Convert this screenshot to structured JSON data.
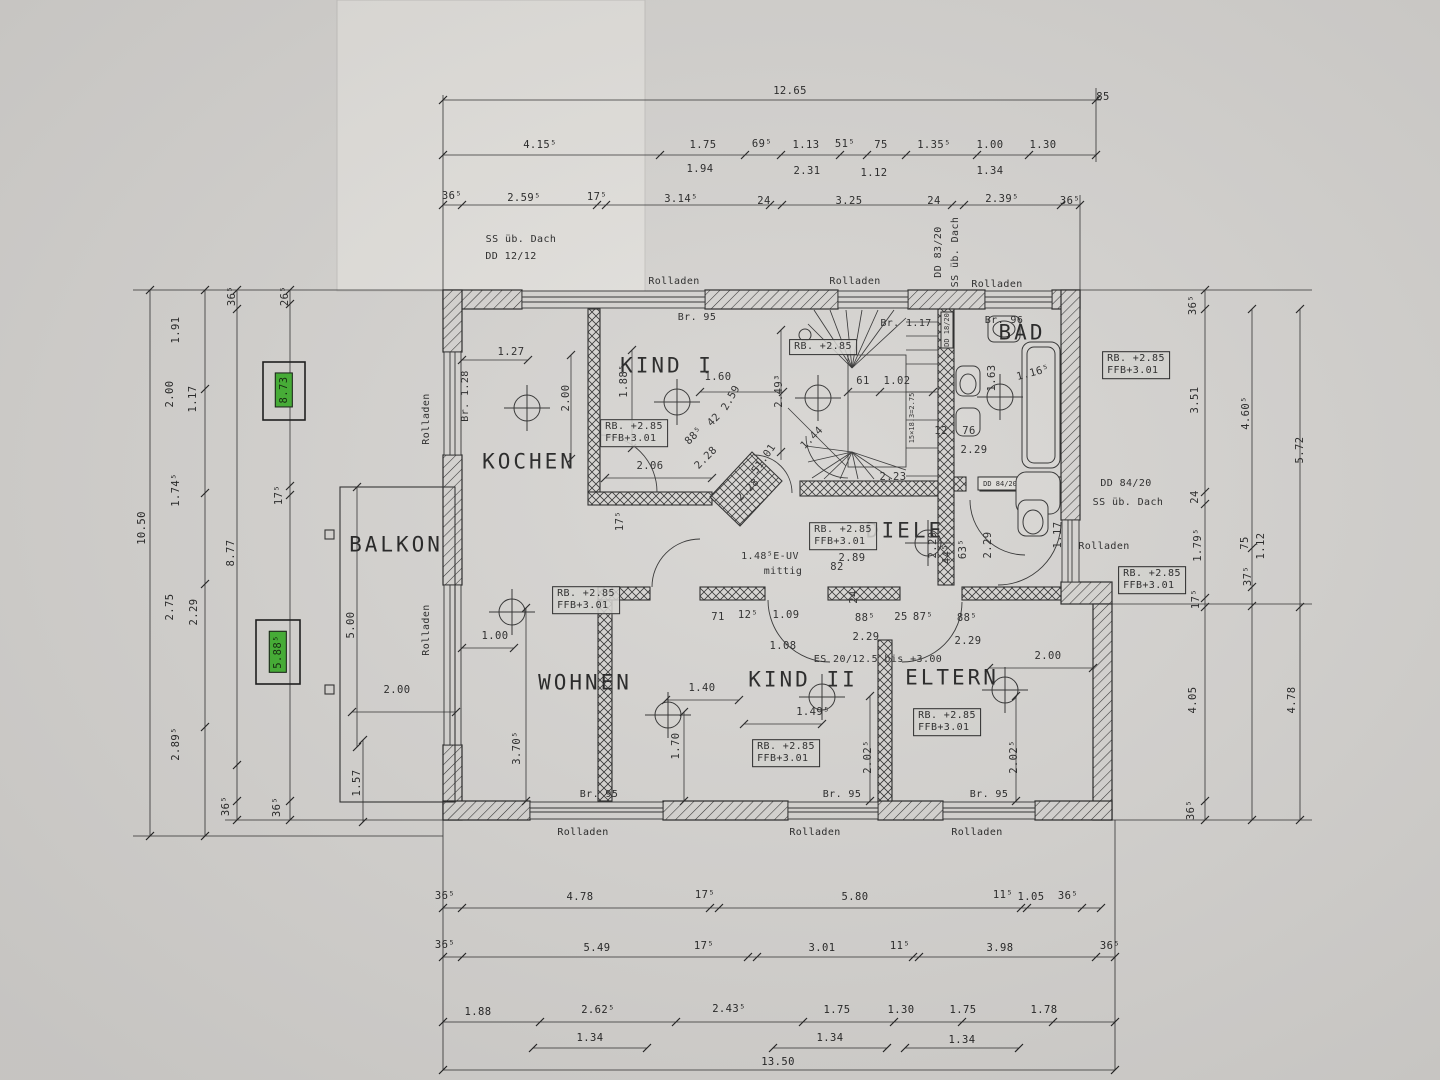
{
  "colors": {
    "paper": "#d5d3d0",
    "ink": "#262626",
    "highlight_green": "#3fae2e",
    "sheet_light": "#e2e0dc"
  },
  "drawing": {
    "type": "floor-plan",
    "language": "de"
  },
  "labels": [
    {
      "t": "12.65",
      "x": 790,
      "y": 91
    },
    {
      "t": "85",
      "x": 1103,
      "y": 97
    },
    {
      "t": "4.15⁵",
      "x": 540,
      "y": 145
    },
    {
      "t": "1.75",
      "x": 703,
      "y": 145
    },
    {
      "t": "69⁵",
      "x": 762,
      "y": 144
    },
    {
      "t": "1.13",
      "x": 806,
      "y": 145
    },
    {
      "t": "51⁵",
      "x": 845,
      "y": 144
    },
    {
      "t": "75",
      "x": 881,
      "y": 145
    },
    {
      "t": "1.35⁵",
      "x": 934,
      "y": 145
    },
    {
      "t": "1.00",
      "x": 990,
      "y": 145
    },
    {
      "t": "1.30",
      "x": 1043,
      "y": 145
    },
    {
      "t": "1.94",
      "x": 700,
      "y": 169
    },
    {
      "t": "2.31",
      "x": 807,
      "y": 171
    },
    {
      "t": "1.12",
      "x": 874,
      "y": 173
    },
    {
      "t": "1.34",
      "x": 990,
      "y": 171
    },
    {
      "t": "36⁵",
      "x": 452,
      "y": 196
    },
    {
      "t": "2.59⁵",
      "x": 524,
      "y": 198
    },
    {
      "t": "17⁵",
      "x": 597,
      "y": 197
    },
    {
      "t": "3.14⁵",
      "x": 681,
      "y": 199
    },
    {
      "t": "24",
      "x": 764,
      "y": 201
    },
    {
      "t": "3.25",
      "x": 849,
      "y": 201
    },
    {
      "t": "24",
      "x": 934,
      "y": 201
    },
    {
      "t": "2.39⁵",
      "x": 1002,
      "y": 199
    },
    {
      "t": "36⁵",
      "x": 1070,
      "y": 201
    },
    {
      "t": "SS üb. Dach",
      "x": 521,
      "y": 240,
      "k": "note"
    },
    {
      "t": "DD 12/12",
      "x": 511,
      "y": 257,
      "k": "note"
    },
    {
      "t": "Rolladen",
      "x": 674,
      "y": 282,
      "k": "note"
    },
    {
      "t": "Rolladen",
      "x": 855,
      "y": 282,
      "k": "note"
    },
    {
      "t": "Rolladen",
      "x": 997,
      "y": 285,
      "k": "note"
    },
    {
      "t": "DD 83/20",
      "x": 939,
      "y": 252,
      "r": -90,
      "k": "note"
    },
    {
      "t": "SS üb. Dach",
      "x": 956,
      "y": 252,
      "r": -90,
      "k": "note"
    },
    {
      "t": "Br. 95",
      "x": 697,
      "y": 318,
      "k": "note"
    },
    {
      "t": "Br. 1.17",
      "x": 906,
      "y": 324,
      "k": "note"
    },
    {
      "t": "Br. 96",
      "x": 1004,
      "y": 321,
      "k": "note"
    },
    {
      "t": "Br. 1.28",
      "x": 466,
      "y": 396,
      "r": -90,
      "k": "note"
    },
    {
      "t": "KOCHEN",
      "x": 529,
      "y": 462,
      "k": "room"
    },
    {
      "t": "KIND I",
      "x": 667,
      "y": 366,
      "k": "room"
    },
    {
      "t": "BAD",
      "x": 1022,
      "y": 333,
      "k": "room"
    },
    {
      "t": "BALKON",
      "x": 396,
      "y": 545,
      "k": "room"
    },
    {
      "t": "WOHNEN",
      "x": 585,
      "y": 683,
      "k": "room"
    },
    {
      "t": "KIND II",
      "x": 803,
      "y": 680,
      "k": "room"
    },
    {
      "t": "ELTERN",
      "x": 952,
      "y": 678,
      "k": "room"
    },
    {
      "t": "DIELE",
      "x": 905,
      "y": 531,
      "k": "room"
    },
    {
      "t": "RB. +2.85\nFFB+3.01",
      "x": 634,
      "y": 433,
      "k": "box"
    },
    {
      "t": "RB. +2.85",
      "x": 823,
      "y": 347,
      "k": "box"
    },
    {
      "t": "RB. +2.85\nFFB+3.01",
      "x": 586,
      "y": 600,
      "k": "box"
    },
    {
      "t": "RB. +2.85\nFFB+3.01",
      "x": 843,
      "y": 536,
      "k": "box"
    },
    {
      "t": "RB. +2.85\nFFB+3.01",
      "x": 786,
      "y": 753,
      "k": "box"
    },
    {
      "t": "RB. +2.85\nFFB+3.01",
      "x": 947,
      "y": 722,
      "k": "box"
    },
    {
      "t": "RB. +2.85\nFFB+3.01",
      "x": 1136,
      "y": 365,
      "k": "box"
    },
    {
      "t": "RB. +2.85\nFFB+3.01",
      "x": 1152,
      "y": 580,
      "k": "box"
    },
    {
      "t": "8.73",
      "x": 284,
      "y": 390,
      "r": -90,
      "k": "green"
    },
    {
      "t": "5.88⁵",
      "x": 278,
      "y": 652,
      "r": -90,
      "k": "green"
    },
    {
      "t": "1.27",
      "x": 511,
      "y": 352
    },
    {
      "t": "2.00",
      "x": 566,
      "y": 398,
      "r": -90
    },
    {
      "t": "1.88⁵",
      "x": 624,
      "y": 381,
      "r": -90
    },
    {
      "t": "1.60",
      "x": 718,
      "y": 377
    },
    {
      "t": "2.06",
      "x": 650,
      "y": 466
    },
    {
      "t": "17⁵",
      "x": 620,
      "y": 521,
      "r": -90
    },
    {
      "t": "88⁵",
      "x": 694,
      "y": 436,
      "r": -45
    },
    {
      "t": "42",
      "x": 714,
      "y": 420,
      "r": -45
    },
    {
      "t": "2.59",
      "x": 731,
      "y": 398,
      "r": -60
    },
    {
      "t": "2.28",
      "x": 706,
      "y": 458,
      "r": -45
    },
    {
      "t": "51.01",
      "x": 764,
      "y": 459,
      "r": -55
    },
    {
      "t": "2.28",
      "x": 748,
      "y": 490,
      "r": -45
    },
    {
      "t": "61",
      "x": 863,
      "y": 381
    },
    {
      "t": "1.02",
      "x": 897,
      "y": 381
    },
    {
      "t": "2.49³",
      "x": 779,
      "y": 391,
      "r": -90
    },
    {
      "t": "1.44",
      "x": 812,
      "y": 438,
      "r": -45
    },
    {
      "t": "2.23",
      "x": 893,
      "y": 477
    },
    {
      "t": "15×18.3=2.75",
      "x": 912,
      "y": 418,
      "r": -90,
      "k": "tiny"
    },
    {
      "t": "DD 18/20",
      "x": 947,
      "y": 330,
      "r": -90,
      "k": "tiny"
    },
    {
      "t": "1.63",
      "x": 992,
      "y": 378,
      "r": -90
    },
    {
      "t": "1.16⁵",
      "x": 1033,
      "y": 373,
      "r": -15
    },
    {
      "t": "12",
      "x": 941,
      "y": 431
    },
    {
      "t": "76",
      "x": 969,
      "y": 431
    },
    {
      "t": "2.29",
      "x": 974,
      "y": 450
    },
    {
      "t": "2.29",
      "x": 933,
      "y": 545,
      "r": -90
    },
    {
      "t": "DD 84/20",
      "x": 1000,
      "y": 484,
      "k": "tiny"
    },
    {
      "t": "DD 84/20",
      "x": 1126,
      "y": 484,
      "k": "note"
    },
    {
      "t": "SS üb. Dach",
      "x": 1128,
      "y": 503,
      "k": "note"
    },
    {
      "t": "Rolladen",
      "x": 1104,
      "y": 547,
      "k": "note"
    },
    {
      "t": "44⁵",
      "x": 947,
      "y": 554,
      "r": -90
    },
    {
      "t": "63⁵",
      "x": 963,
      "y": 549,
      "r": -90
    },
    {
      "t": "2.29",
      "x": 988,
      "y": 545,
      "r": -90
    },
    {
      "t": "1.17",
      "x": 1058,
      "y": 535,
      "r": -90
    },
    {
      "t": "2.89",
      "x": 852,
      "y": 558
    },
    {
      "t": "82",
      "x": 837,
      "y": 567
    },
    {
      "t": "24",
      "x": 854,
      "y": 597,
      "r": -90
    },
    {
      "t": "1.48⁵E-UV",
      "x": 770,
      "y": 557,
      "k": "note"
    },
    {
      "t": "mittig",
      "x": 783,
      "y": 572,
      "k": "note"
    },
    {
      "t": "71",
      "x": 718,
      "y": 617
    },
    {
      "t": "12⁵",
      "x": 748,
      "y": 615
    },
    {
      "t": "1.09",
      "x": 786,
      "y": 615
    },
    {
      "t": "1.08",
      "x": 783,
      "y": 646
    },
    {
      "t": "88⁵",
      "x": 865,
      "y": 618
    },
    {
      "t": "25",
      "x": 901,
      "y": 617
    },
    {
      "t": "87⁵",
      "x": 923,
      "y": 617
    },
    {
      "t": "88⁵",
      "x": 967,
      "y": 618
    },
    {
      "t": "2.29",
      "x": 866,
      "y": 637
    },
    {
      "t": "2.29",
      "x": 968,
      "y": 641
    },
    {
      "t": "ES 20/12.5 bis +3.00",
      "x": 878,
      "y": 660,
      "k": "note"
    },
    {
      "t": "1.40",
      "x": 702,
      "y": 688
    },
    {
      "t": "1.70",
      "x": 676,
      "y": 746,
      "r": -90
    },
    {
      "t": "1.49⁵",
      "x": 813,
      "y": 712
    },
    {
      "t": "2.02⁵",
      "x": 868,
      "y": 757,
      "r": -90
    },
    {
      "t": "2.00",
      "x": 1048,
      "y": 656
    },
    {
      "t": "2.02⁵",
      "x": 1014,
      "y": 757,
      "r": -90
    },
    {
      "t": "1.00",
      "x": 495,
      "y": 636
    },
    {
      "t": "3.70⁵",
      "x": 517,
      "y": 748,
      "r": -90
    },
    {
      "t": "5.00",
      "x": 351,
      "y": 625,
      "r": -90
    },
    {
      "t": "2.00",
      "x": 397,
      "y": 690
    },
    {
      "t": "1.57",
      "x": 357,
      "y": 783,
      "r": -90
    },
    {
      "t": "Rolladen",
      "x": 427,
      "y": 419,
      "r": -90,
      "k": "note"
    },
    {
      "t": "Rolladen",
      "x": 427,
      "y": 630,
      "r": -90,
      "k": "note"
    },
    {
      "t": "10.50",
      "x": 142,
      "y": 528,
      "r": -90
    },
    {
      "t": "1.91",
      "x": 176,
      "y": 330,
      "r": -90
    },
    {
      "t": "2.00",
      "x": 170,
      "y": 394,
      "r": -90
    },
    {
      "t": "1.17",
      "x": 193,
      "y": 399,
      "r": -90
    },
    {
      "t": "1.74⁵",
      "x": 176,
      "y": 490,
      "r": -90
    },
    {
      "t": "2.75",
      "x": 170,
      "y": 607,
      "r": -90
    },
    {
      "t": "2.29",
      "x": 194,
      "y": 612,
      "r": -90
    },
    {
      "t": "2.89⁵",
      "x": 176,
      "y": 744,
      "r": -90
    },
    {
      "t": "36⁵",
      "x": 232,
      "y": 296,
      "r": -90
    },
    {
      "t": "8.77",
      "x": 231,
      "y": 553,
      "r": -90
    },
    {
      "t": "36⁵",
      "x": 226,
      "y": 806,
      "r": -90
    },
    {
      "t": "26⁵",
      "x": 285,
      "y": 296,
      "r": -90
    },
    {
      "t": "17⁵",
      "x": 279,
      "y": 495,
      "r": -90
    },
    {
      "t": "36⁵",
      "x": 277,
      "y": 807,
      "r": -90
    },
    {
      "t": "36⁵",
      "x": 1193,
      "y": 305,
      "r": -90
    },
    {
      "t": "3.51",
      "x": 1195,
      "y": 400,
      "r": -90
    },
    {
      "t": "24",
      "x": 1195,
      "y": 497,
      "r": -90
    },
    {
      "t": "1.79⁵",
      "x": 1198,
      "y": 545,
      "r": -90
    },
    {
      "t": "17⁵",
      "x": 1196,
      "y": 599,
      "r": -90
    },
    {
      "t": "4.05",
      "x": 1193,
      "y": 700,
      "r": -90
    },
    {
      "t": "36⁵",
      "x": 1191,
      "y": 810,
      "r": -90
    },
    {
      "t": "4.60⁵",
      "x": 1246,
      "y": 413,
      "r": -90
    },
    {
      "t": "75",
      "x": 1245,
      "y": 543,
      "r": -90
    },
    {
      "t": "37⁵",
      "x": 1248,
      "y": 576,
      "r": -90
    },
    {
      "t": "1.12",
      "x": 1261,
      "y": 546,
      "r": -90
    },
    {
      "t": "4.78",
      "x": 1292,
      "y": 700,
      "r": -90
    },
    {
      "t": "5.72",
      "x": 1300,
      "y": 450,
      "r": -90
    },
    {
      "t": "Br. 95",
      "x": 599,
      "y": 795,
      "k": "note"
    },
    {
      "t": "Br. 95",
      "x": 842,
      "y": 795,
      "k": "note"
    },
    {
      "t": "Br. 95",
      "x": 989,
      "y": 795,
      "k": "note"
    },
    {
      "t": "Rolladen",
      "x": 583,
      "y": 833,
      "k": "note"
    },
    {
      "t": "Rolladen",
      "x": 815,
      "y": 833,
      "k": "note"
    },
    {
      "t": "Rolladen",
      "x": 977,
      "y": 833,
      "k": "note"
    },
    {
      "t": "36⁵",
      "x": 445,
      "y": 896
    },
    {
      "t": "4.78",
      "x": 580,
      "y": 897
    },
    {
      "t": "17⁵",
      "x": 705,
      "y": 895
    },
    {
      "t": "5.80",
      "x": 855,
      "y": 897
    },
    {
      "t": "11⁵",
      "x": 1003,
      "y": 895
    },
    {
      "t": "1.05",
      "x": 1031,
      "y": 897
    },
    {
      "t": "36⁵",
      "x": 1068,
      "y": 896
    },
    {
      "t": "36⁵",
      "x": 445,
      "y": 945
    },
    {
      "t": "5.49",
      "x": 597,
      "y": 948
    },
    {
      "t": "17⁵",
      "x": 704,
      "y": 946
    },
    {
      "t": "3.01",
      "x": 822,
      "y": 948
    },
    {
      "t": "11⁵",
      "x": 900,
      "y": 946
    },
    {
      "t": "3.98",
      "x": 1000,
      "y": 948
    },
    {
      "t": "36⁵",
      "x": 1110,
      "y": 946
    },
    {
      "t": "1.88",
      "x": 478,
      "y": 1012
    },
    {
      "t": "2.62⁵",
      "x": 598,
      "y": 1010
    },
    {
      "t": "2.43⁵",
      "x": 729,
      "y": 1009
    },
    {
      "t": "1.75",
      "x": 837,
      "y": 1010
    },
    {
      "t": "1.30",
      "x": 901,
      "y": 1010
    },
    {
      "t": "1.75",
      "x": 963,
      "y": 1010
    },
    {
      "t": "1.78",
      "x": 1044,
      "y": 1010
    },
    {
      "t": "1.34",
      "x": 590,
      "y": 1038
    },
    {
      "t": "1.34",
      "x": 830,
      "y": 1038
    },
    {
      "t": "1.34",
      "x": 962,
      "y": 1040
    },
    {
      "t": "13.50",
      "x": 778,
      "y": 1062
    }
  ]
}
